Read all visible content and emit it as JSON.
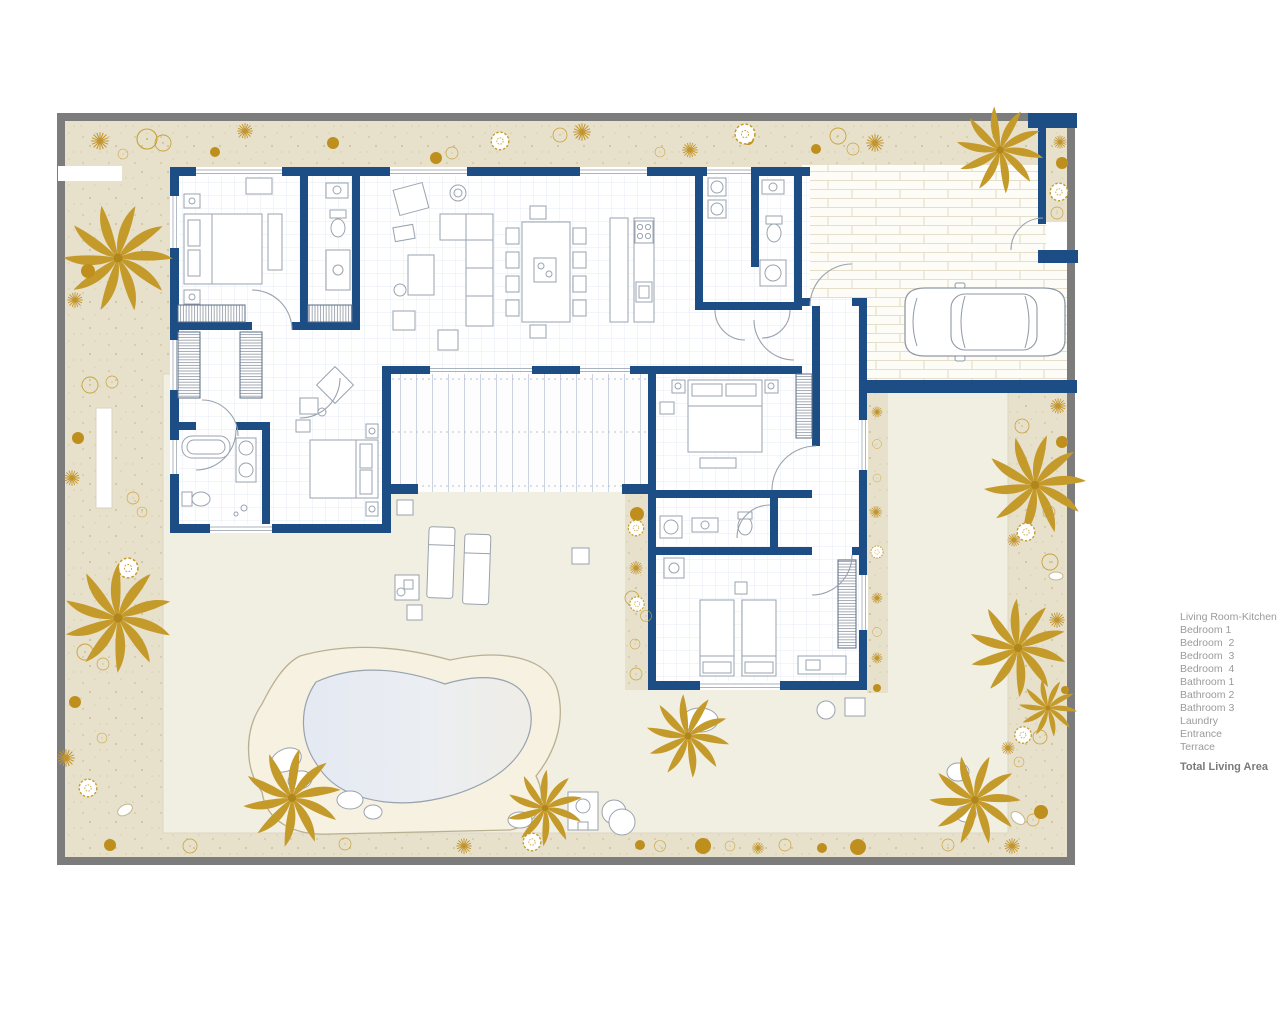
{
  "legend": {
    "items": [
      "Living Room-Kitchen",
      "Bedroom 1",
      "Bedroom  2",
      "Bedroom  3",
      "Bedroom  4",
      "Bathroom 1",
      "Bathroom 2",
      "Bathroom 3",
      "Laundry",
      "Entrance",
      "Terrace"
    ],
    "total_label": "Total Living Area"
  },
  "colors": {
    "wall_navy": "#1d4d85",
    "plant_gold": "#c49a2a",
    "garden_beige": "#e7e0ca",
    "patio_cream": "#f1eee2",
    "pool_water": "#e9edf4",
    "frame_gray": "#7c7c7c"
  },
  "icons": {
    "palm-tree-icon": "radial palm plan symbol",
    "shrub-icon": "dashed circle shrub symbol",
    "starburst-plant-icon": "radial ray plant symbol",
    "car-icon": "car top view outline",
    "pool-icon": "organic pool shape"
  }
}
